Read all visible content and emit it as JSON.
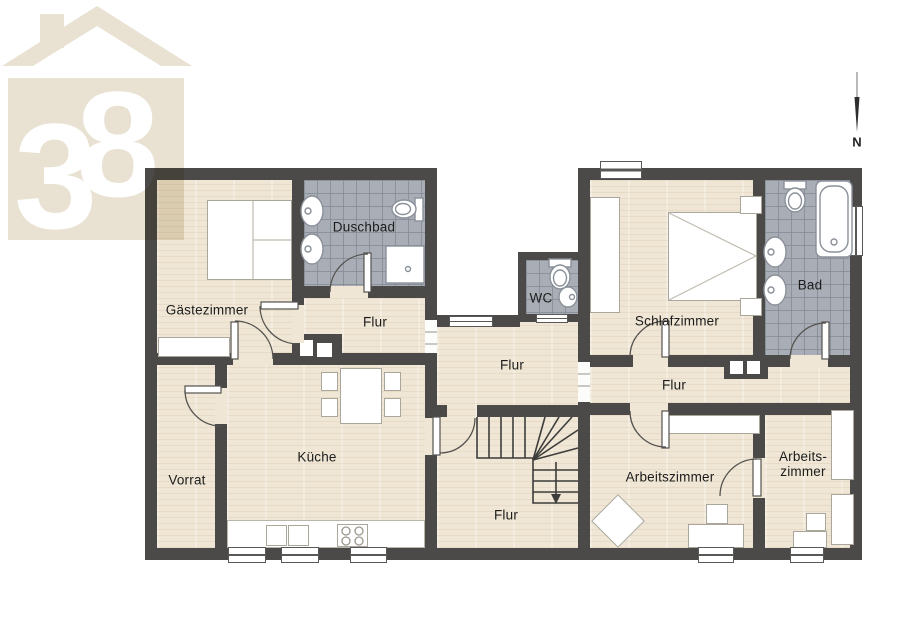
{
  "logo": {
    "digit_first": "3",
    "digit_second": "8",
    "color": "#e9e2d2"
  },
  "compass": {
    "label": "N"
  },
  "palette": {
    "wall": "#4b4a48",
    "floor": "#efe6d5",
    "tile": "#a9aeb6",
    "logo": "#e9e2d2"
  },
  "rooms": {
    "gaestezimmer": {
      "label": "Gästezimmer"
    },
    "duschbad": {
      "label": "Duschbad"
    },
    "flur_links": {
      "label": "Flur"
    },
    "wc": {
      "label": "WC"
    },
    "schlafzimmer": {
      "label": "Schlafzimmer"
    },
    "bad": {
      "label": "Bad"
    },
    "vorrat": {
      "label": "Vorrat"
    },
    "kueche": {
      "label": "Küche"
    },
    "flur_mitte": {
      "label": "Flur"
    },
    "flur_unten": {
      "label": "Flur"
    },
    "flur_rechts": {
      "label": "Flur"
    },
    "arbeitszimmer": {
      "label": "Arbeitszimmer"
    },
    "arbeitszimmer_klein": {
      "label_line1": "Arbeits-",
      "label_line2": "zimmer"
    }
  }
}
